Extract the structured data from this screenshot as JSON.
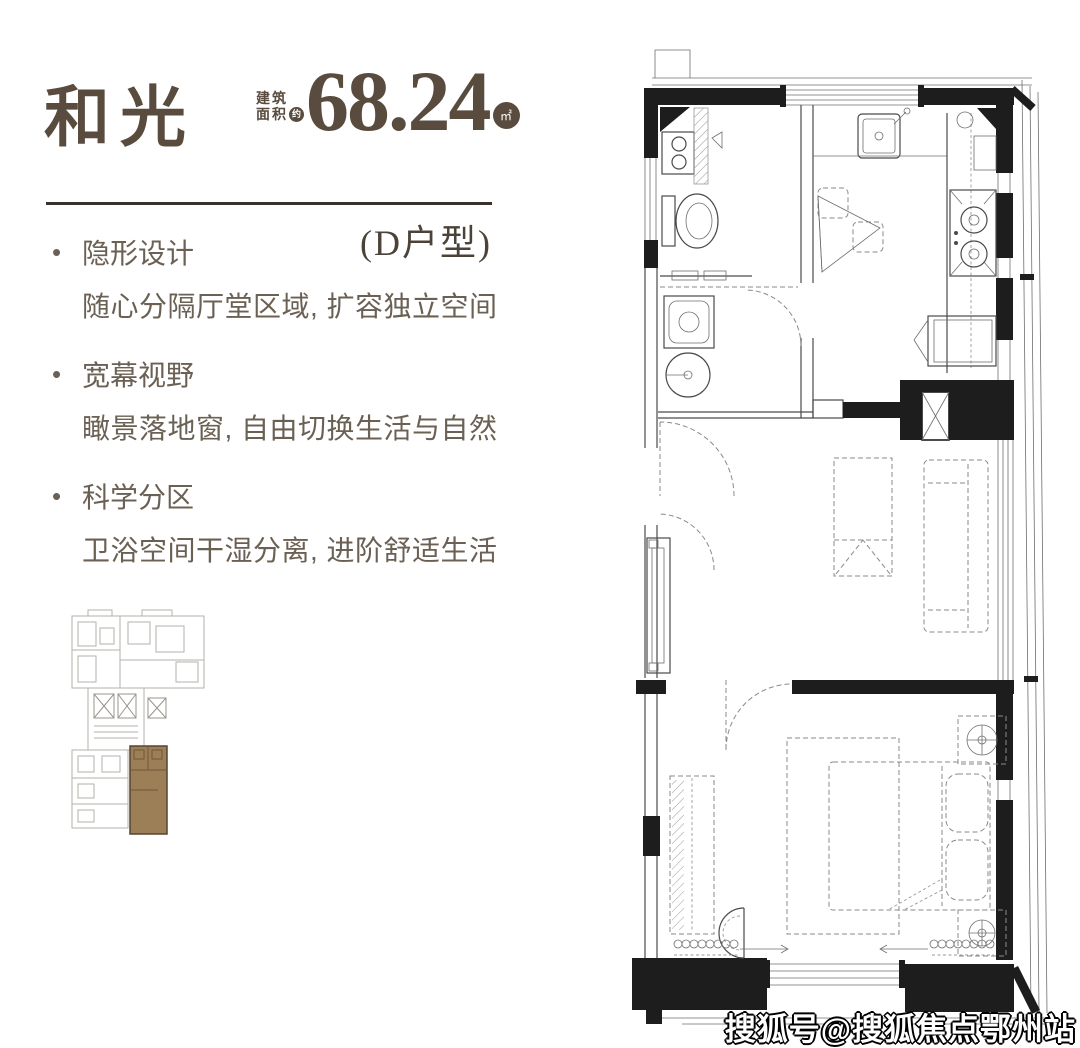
{
  "header": {
    "title": "和光",
    "area_label_top": "建筑",
    "area_label_bottom": "面积",
    "area_approx_badge": "约",
    "area_value": "68.24",
    "area_unit_badge": "㎡",
    "unit_type": "(D户型)"
  },
  "features": [
    {
      "title": "隐形设计",
      "desc": "随心分隔厅堂区域, 扩容独立空间"
    },
    {
      "title": "宽幕视野",
      "desc": "瞰景落地窗, 自由切换生活与自然"
    },
    {
      "title": "科学分区",
      "desc": "卫浴空间干湿分离, 进阶舒适生活"
    }
  ],
  "bullet_glyph": "•",
  "keyplan": {
    "highlighted_unit": "D"
  },
  "colors": {
    "brand_brown": "#594b3e",
    "text_brown": "#6b6054",
    "keyplan_highlight": "#9c7f56",
    "wall_black": "#1d1d1d"
  },
  "watermark": "搜狐号@搜狐焦点鄂州站"
}
